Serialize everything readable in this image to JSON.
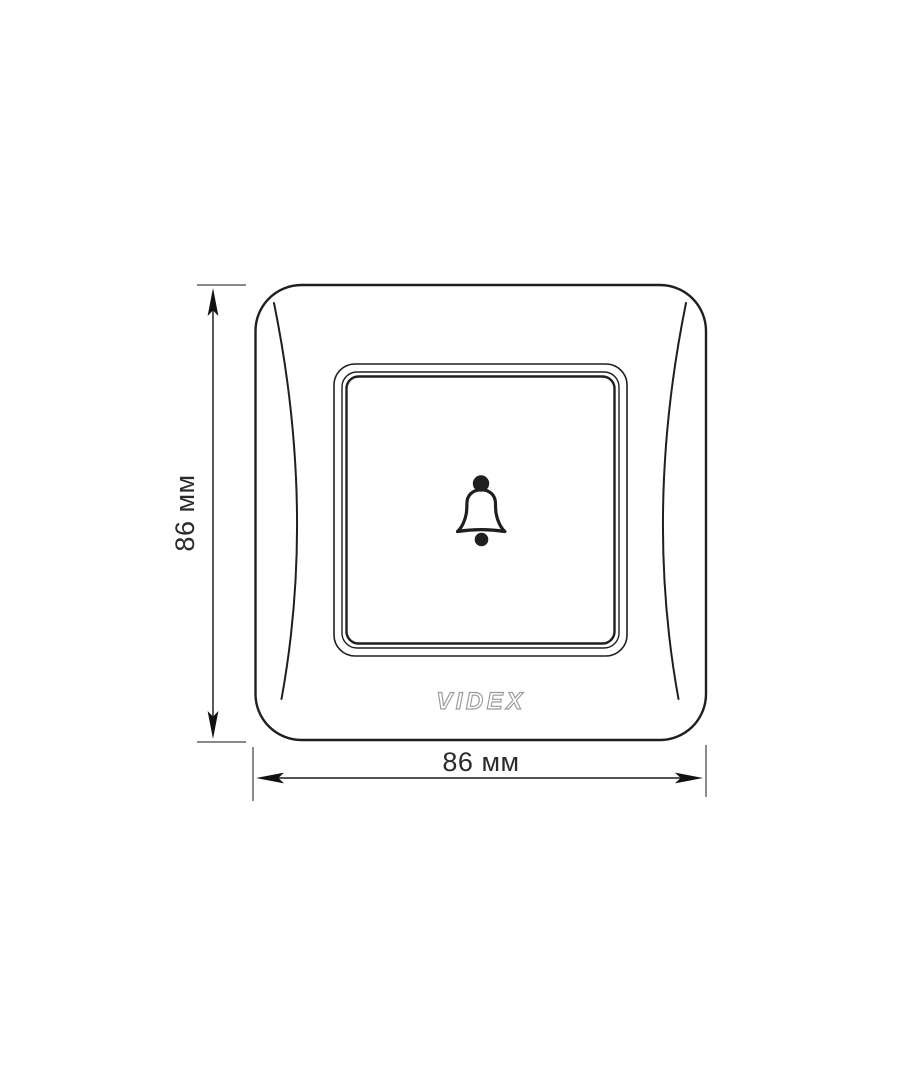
{
  "plate": {
    "logo_text": "VIDEX",
    "center_icon": "bell-icon"
  },
  "dimensions": {
    "height_label": "86 мм",
    "width_label": "86 мм"
  },
  "colors": {
    "outline": "#1f1f1f",
    "dimension_line": "#3c3c3c",
    "extension_tick": "#777777",
    "arrow": "#111111",
    "logo_outline": "#9a9a9a",
    "background": "#ffffff"
  }
}
